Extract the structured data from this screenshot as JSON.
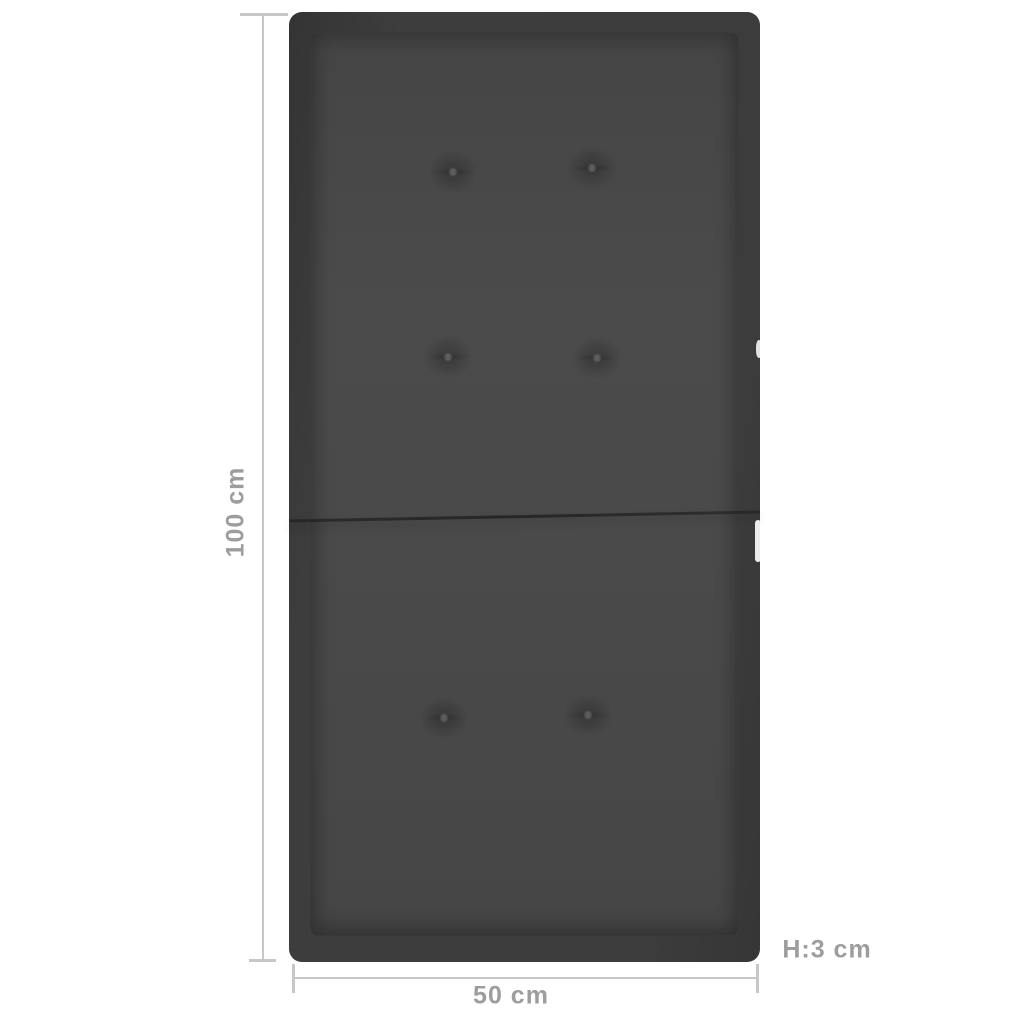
{
  "image": {
    "subject": "dark anthracite folded seat cushion with six tufted buttons, shown with measurement lines"
  },
  "dimensions": {
    "height_label": "100 cm",
    "width_label": "50 cm",
    "thickness_label": "H:3 cm"
  },
  "colors": {
    "background": "#ffffff",
    "label_text": "#9d9d9d",
    "dimension_line": "#c7c7c7",
    "cushion_edge": "#3a3a3a",
    "cushion_surface": "#4a4a4a"
  }
}
